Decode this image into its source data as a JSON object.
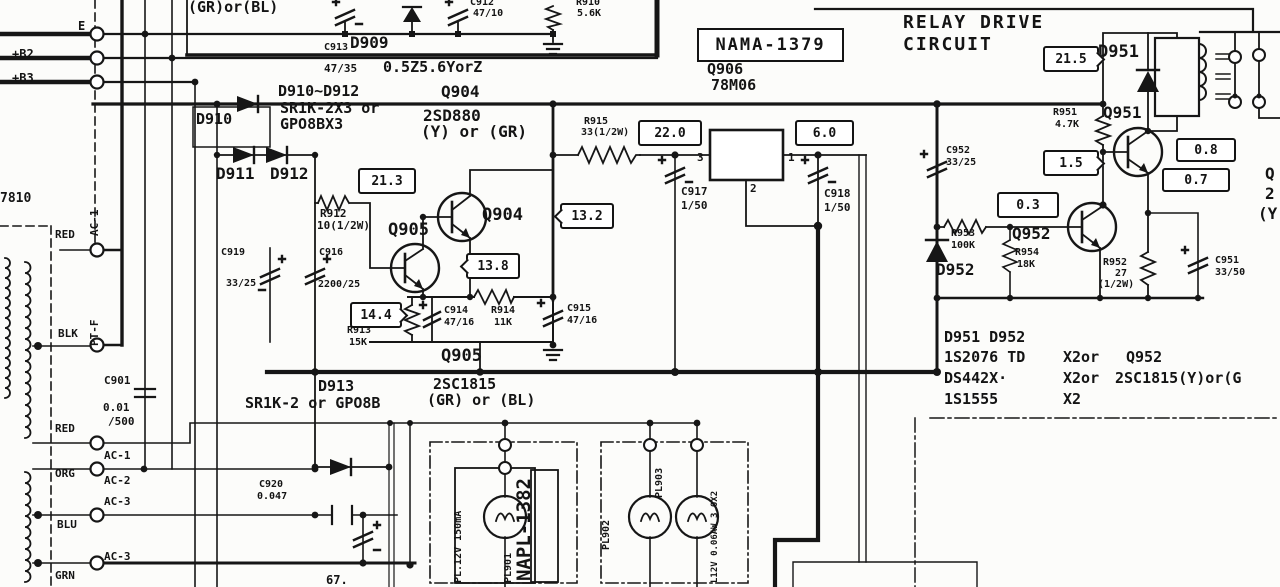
{
  "title": {
    "line1": "RELAY DRIVE",
    "line2": "CIRCUIT"
  },
  "boards": {
    "main": "NAMA-1379",
    "lamp": "NAPL-1382",
    "ref": "7810",
    "frag_bottom": "67."
  },
  "rails": {
    "e": "E",
    "b2": "+B2",
    "b3": "+B3"
  },
  "left": {
    "red_top": "RED",
    "blk": "BLK",
    "red": "RED",
    "org": "ORG",
    "blu": "BLU",
    "grn": "GRN",
    "ac1_v": "AC-1",
    "ptf_v": "PT-F",
    "ac1": "AC-1",
    "ac2": "AC-2",
    "ac3_a": "AC-3",
    "ac3_b": "AC-3",
    "c901": "C901",
    "c901_v1": "0.01",
    "c901_v2": "/500"
  },
  "top_box": {
    "variant": "(GR)or(BL)",
    "c913": "C913",
    "c913_val": "47/35",
    "d909": "D909",
    "d909_type": "0.5Z5.6YorZ",
    "c912": "C912",
    "c912_val": "47/10",
    "r910": "R910",
    "r910_val": "5.6K"
  },
  "rect_group": {
    "diodes": "D910~D912",
    "type1": "SR1K-2X3 or",
    "type2": "GPO8BX3",
    "q904_ref": "Q904",
    "q904_type": "2SD880",
    "q904_grade": "(Y) or (GR)",
    "d910": "D910",
    "d911": "D911",
    "d912": "D912"
  },
  "reg": {
    "q906": "Q906",
    "type": "78M06",
    "pin1": "1",
    "pin2": "2",
    "pin3": "3",
    "r915": "R915",
    "r915_val": "33(1/2W)",
    "c917": "C917",
    "c917_val": "1/50",
    "c918": "C918",
    "c918_val": "1/50"
  },
  "stage": {
    "q905_top": "Q905",
    "q904": "Q904",
    "q905_bottom": "Q905",
    "r912": "R912",
    "r912_val": "10(1/2W)",
    "c919": "C919",
    "c919_val": "33/25",
    "c916": "C916",
    "c916_val": "2200/25",
    "r913": "R913",
    "r913_val": "15K",
    "c914": "C914",
    "c914_val": "47/16",
    "r914": "R914",
    "r914_val": "11K",
    "c915": "C915",
    "c915_val": "47/16"
  },
  "d913grp": {
    "ref": "D913",
    "type": "SR1K-2 or GPO8B",
    "q_type": "2SC1815",
    "q_grade": "(GR) or (BL)",
    "c920": "C920",
    "c920_val": "0.047"
  },
  "relay": {
    "d951": "D951",
    "q951": "Q951",
    "r951": "R951",
    "r951_val": "4.7K",
    "c952": "C952",
    "c952_val": "33/25",
    "d952": "D952",
    "q952": "Q952",
    "r953": "R953",
    "r953_val": "100K",
    "r954": "R954",
    "r954_val": "18K",
    "r952": "R952",
    "r952_val": "27",
    "r952_w": "(1/2W)",
    "c951": "C951",
    "c951_val": "33/50"
  },
  "tp": {
    "v21_3": "21.3",
    "v13_8": "13.8",
    "v14_4": "14.4",
    "v13_2": "13.2",
    "v22_0": "22.0",
    "v6_0": "6.0",
    "v21_5": "21.5",
    "v1_5": "1.5",
    "v0_8": "0.8",
    "v0_7": "0.7",
    "v0_3": "0.3"
  },
  "lamps": {
    "pl901_spec": "PL.12V 150mA",
    "pl901": "PL901",
    "pl902": "PL902",
    "pl903": "PL903",
    "spec": "L12V 0.06AW 3.0X2"
  },
  "parts": {
    "r1": "D951 D952",
    "r2a": "1S2076 TD",
    "r2b": "X2or",
    "r2c": "Q952",
    "r3a": "DS442X·",
    "r3b": "X2or",
    "r3c": "2SC1815(Y)or(G",
    "r4a": "1S1555",
    "r4b": "X2"
  },
  "edge": {
    "f1": "Q",
    "f2": "2",
    "f3": "(Y"
  }
}
